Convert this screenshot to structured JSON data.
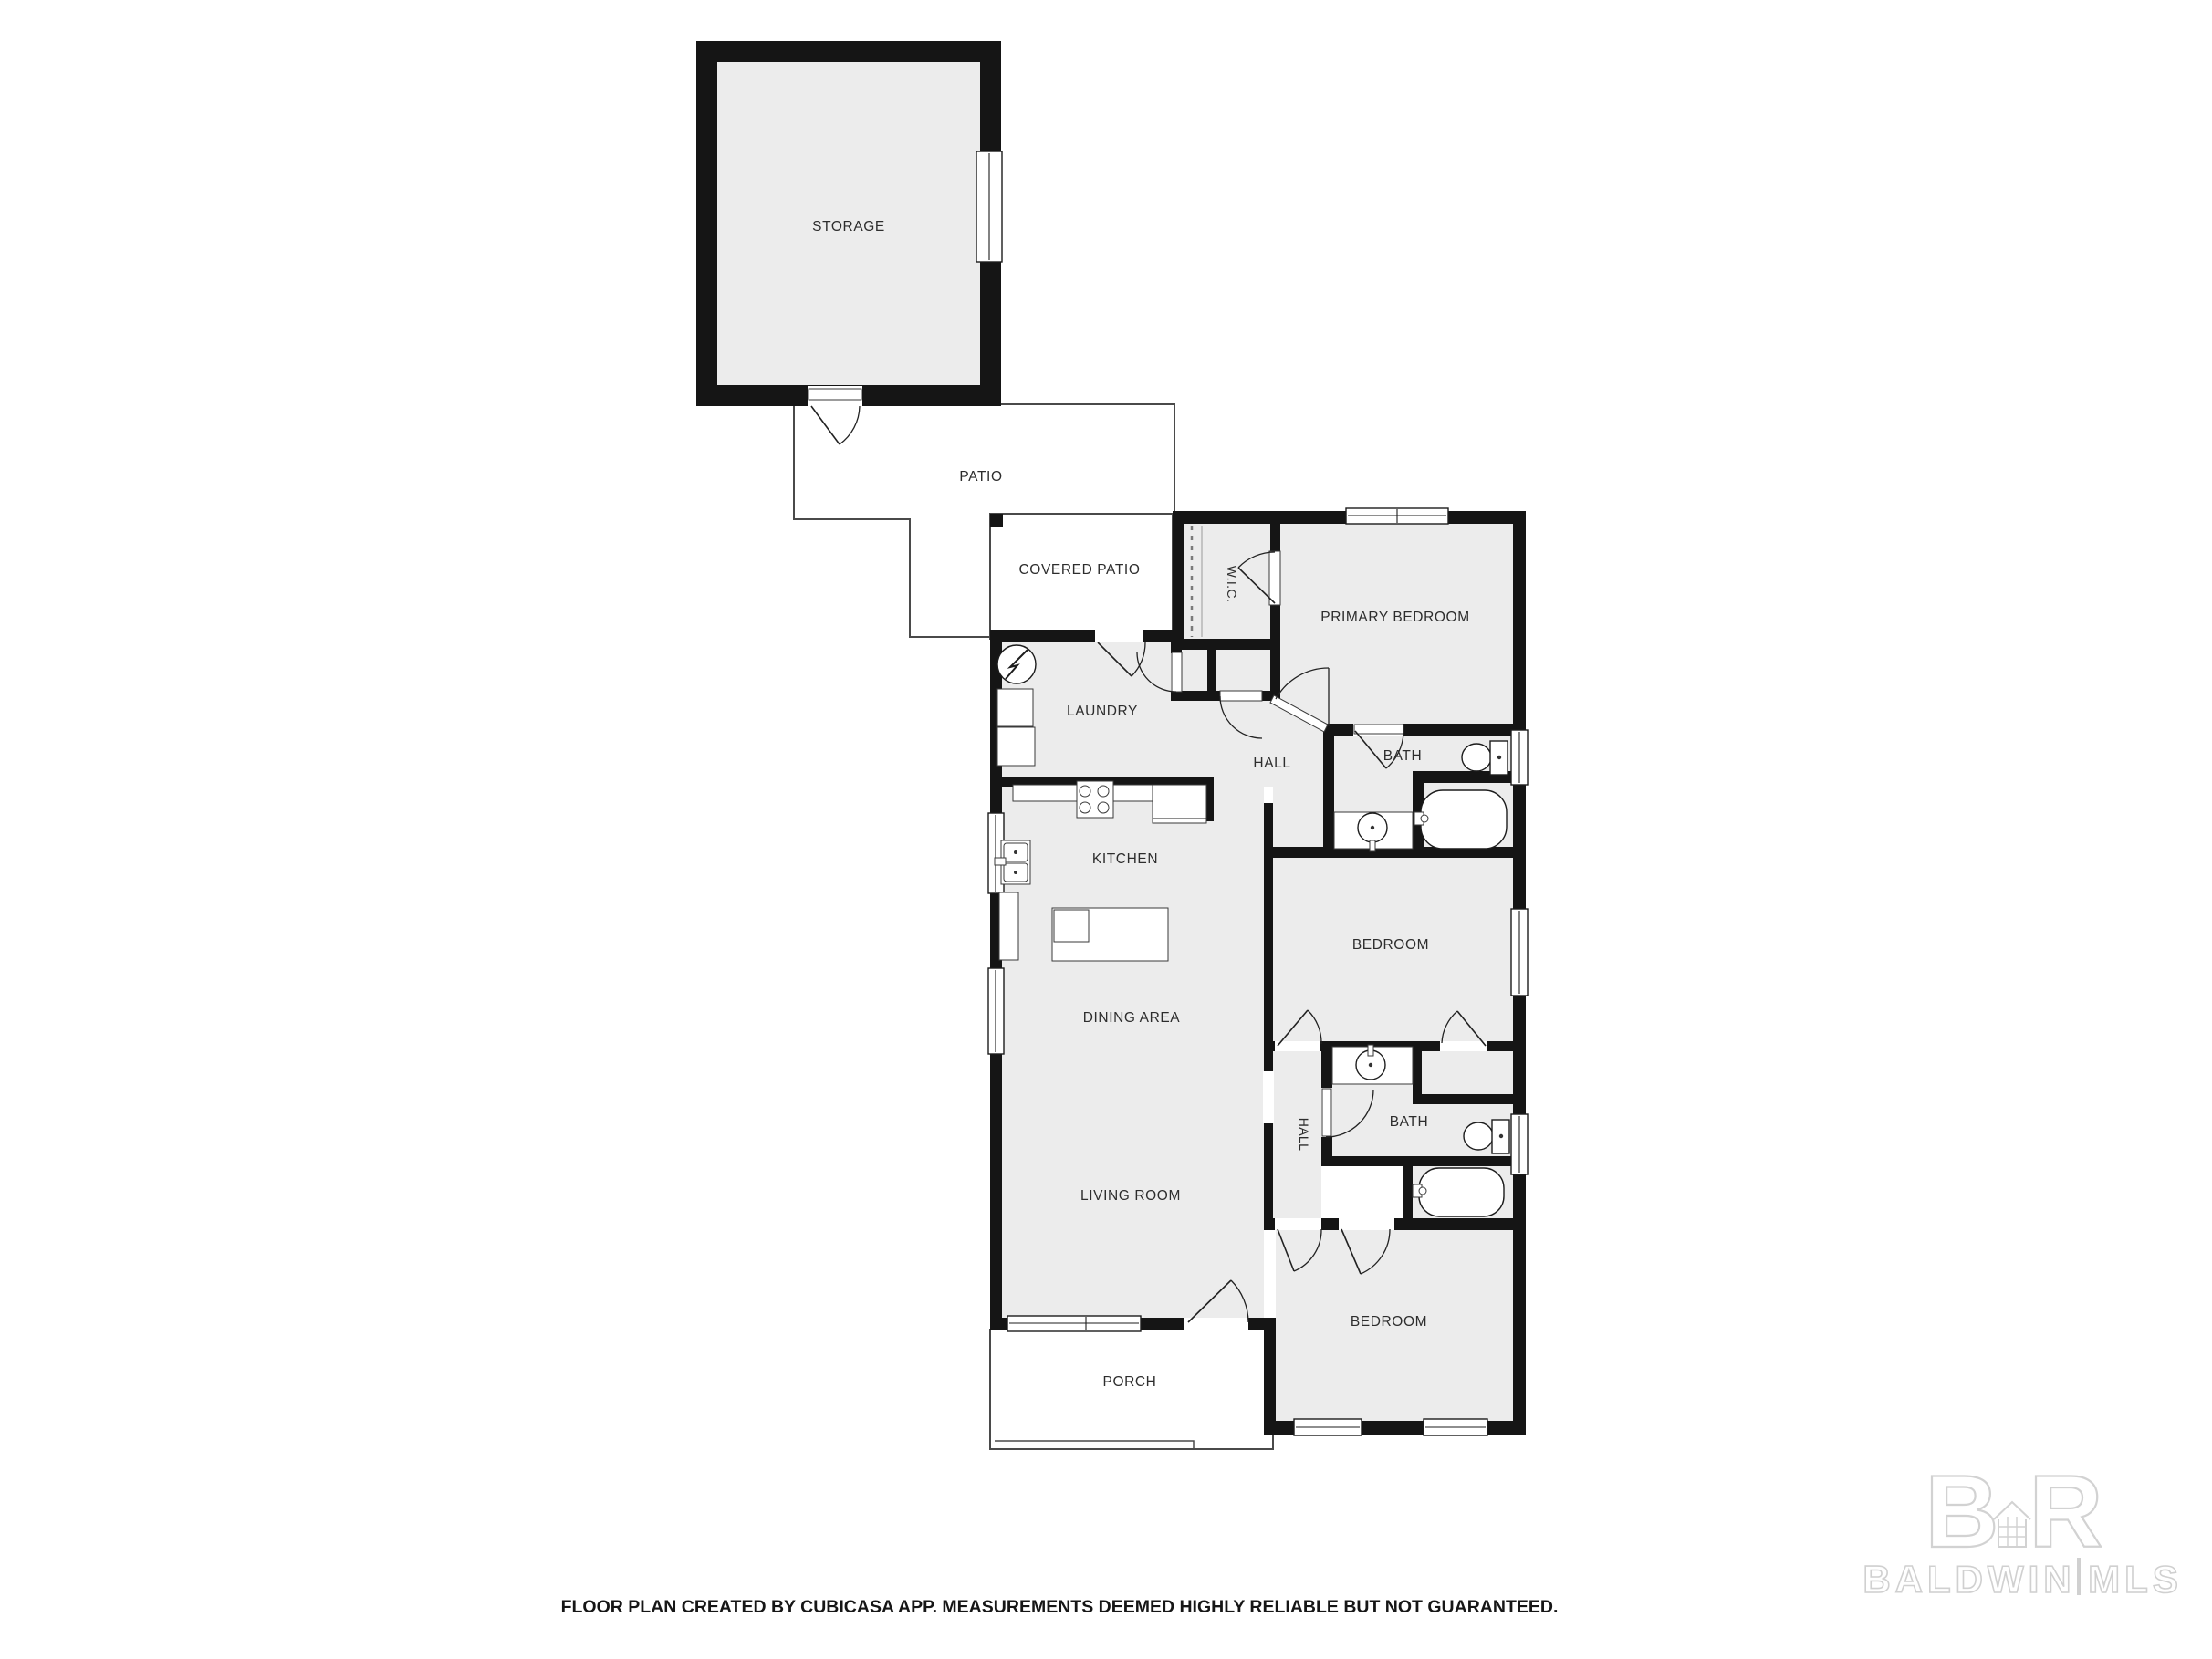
{
  "floor_plan": {
    "rooms": {
      "storage": "STORAGE",
      "patio": "PATIO",
      "covered_patio": "COVERED PATIO",
      "wic": "W.I.C.",
      "primary_bedroom": "PRIMARY BEDROOM",
      "laundry": "LAUNDRY",
      "hall_upper": "HALL",
      "primary_bath": "BATH",
      "kitchen": "KITCHEN",
      "middle_bedroom": "BEDROOM",
      "dining_area": "DINING AREA",
      "hall_lower": "HALL",
      "second_bath": "BATH",
      "living_room": "LIVING ROOM",
      "rear_bedroom": "BEDROOM",
      "porch": "PORCH"
    },
    "colors": {
      "wall": "#151515",
      "room_fill": "#ececec",
      "background": "#ffffff",
      "watermark": "#d0d0d0"
    },
    "footer": {
      "disclaimer": "FLOOR PLAN CREATED BY CUBICASA APP. MEASUREMENTS DEEMED HIGHLY RELIABLE BUT NOT GUARANTEED."
    },
    "watermark": {
      "initial_b": "B",
      "initial_r": "R",
      "name": "BALDWIN",
      "separator": "|",
      "suffix": "MLS"
    }
  }
}
